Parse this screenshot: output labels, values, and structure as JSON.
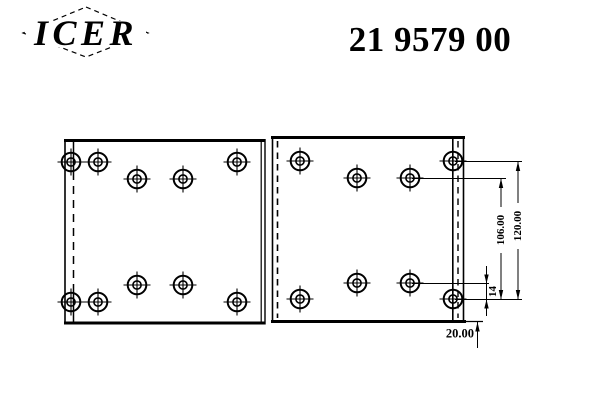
{
  "header": {
    "logo_text": "ICER",
    "part_number": "21 9579 00"
  },
  "drawing": {
    "description": "brake-lining-technical-drawing-two-plates-with-rivet-holes",
    "dim_labels": {
      "height_106": "106.00",
      "height_120": "120.00",
      "offset_14": "14",
      "offset_20": "20.00"
    },
    "holes": {
      "left_plate": [
        [
          71,
          162
        ],
        [
          98,
          162
        ],
        [
          137,
          179
        ],
        [
          183,
          179
        ],
        [
          237,
          162
        ],
        [
          71,
          302
        ],
        [
          98,
          302
        ],
        [
          137,
          285
        ],
        [
          183,
          285
        ],
        [
          237,
          302
        ]
      ],
      "right_plate": [
        [
          300,
          161
        ],
        [
          357,
          178
        ],
        [
          410,
          178
        ],
        [
          453,
          161
        ],
        [
          300,
          299
        ],
        [
          357,
          283
        ],
        [
          410,
          283
        ],
        [
          453,
          299
        ]
      ]
    }
  },
  "colors": {
    "ink": "#000000",
    "background": "#ffffff"
  }
}
